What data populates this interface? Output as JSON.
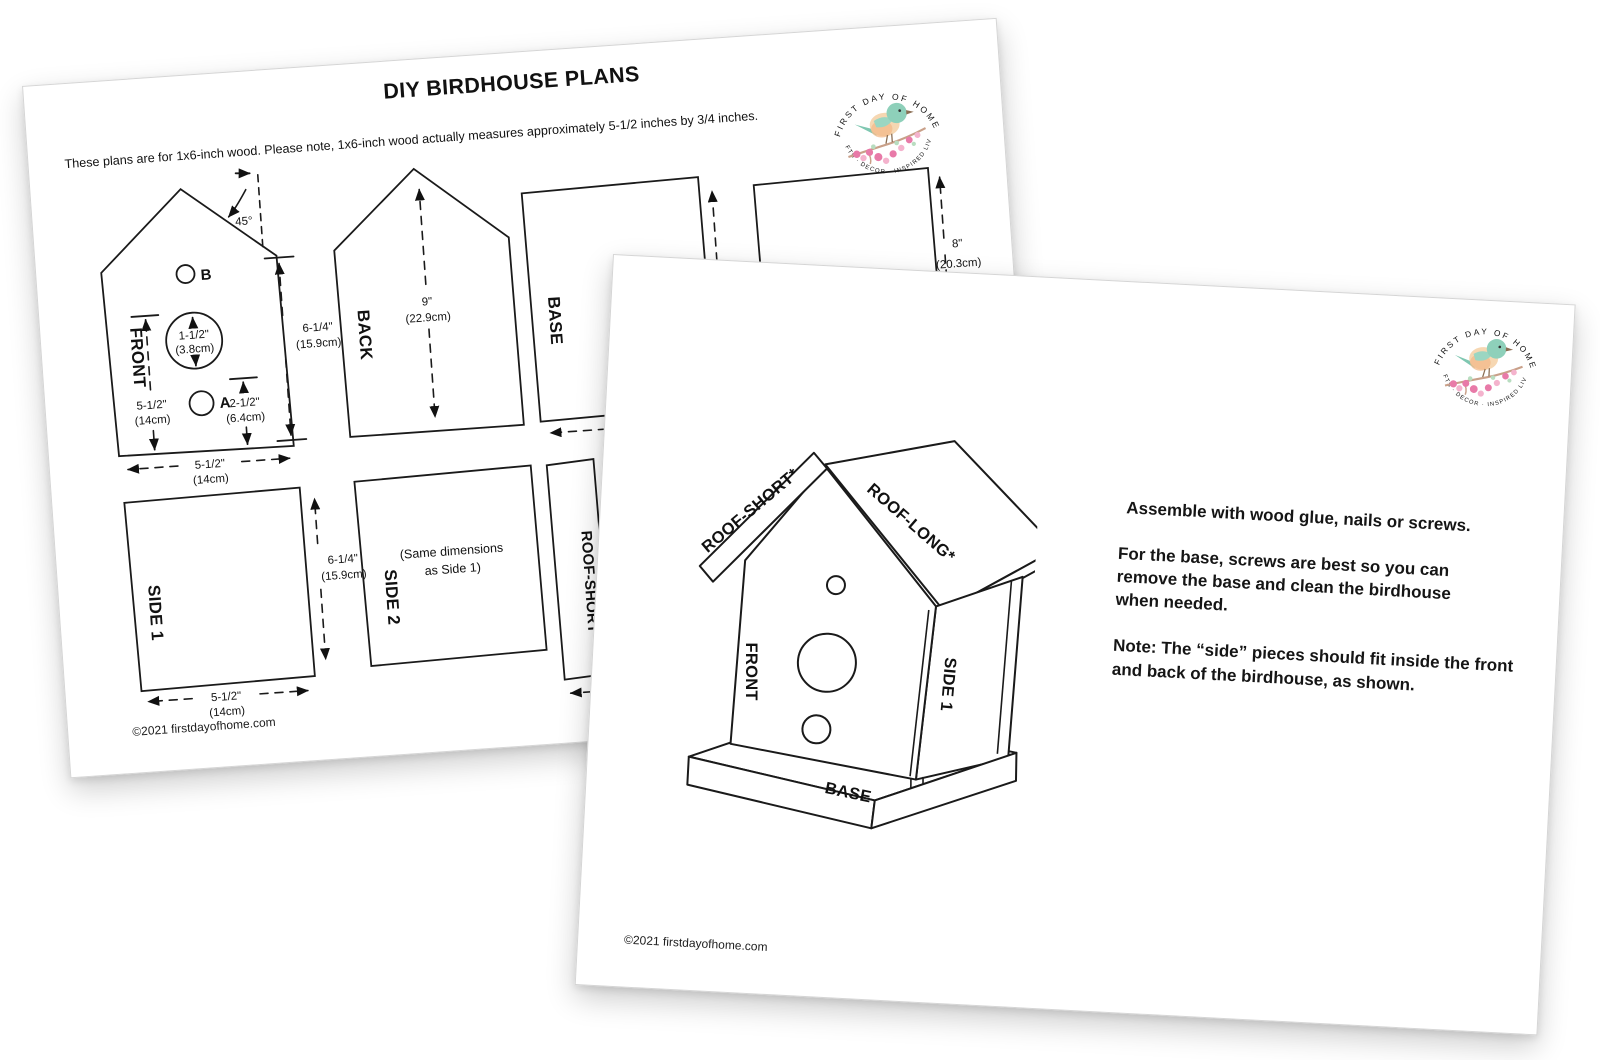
{
  "back_page": {
    "title": "DIY BIRDHOUSE PLANS",
    "subtitle": "These plans are for 1x6-inch wood. Please note, 1x6-inch wood actually measures approximately 5-1/2 inches by 3/4 inches.",
    "copyright": "©2021 firstdayofhome.com",
    "front_piece": {
      "label": "FRONT",
      "angle_label": "45°",
      "hole_b_label": "B",
      "hole_a_label": "A",
      "hole_dia_in": "1-1/2\"",
      "hole_dia_cm": "(3.8cm)",
      "left_height_in": "5-1/2\"",
      "left_height_cm": "(14cm)",
      "hole_a_offset_in": "2-1/2\"",
      "hole_a_offset_cm": "(6.4cm)",
      "right_height_in": "6-1/4\"",
      "right_height_cm": "(15.9cm)",
      "width_in": "5-1/2\"",
      "width_cm": "(14cm)"
    },
    "back_piece": {
      "label": "BACK",
      "height_in": "9\"",
      "height_cm": "(22.9cm)"
    },
    "base_piece": {
      "label": "BASE"
    },
    "roof_long_piece": {
      "height_in": "8\"",
      "height_cm": "(20.3cm)"
    },
    "side1_piece": {
      "label": "SIDE 1",
      "width_in": "5-1/2\"",
      "width_cm": "(14cm)",
      "height_in": "6-1/4\"",
      "height_cm": "(15.9cm)"
    },
    "side2_piece": {
      "label": "SIDE 2",
      "note1": "(Same dimensions",
      "note2": "as Side 1)"
    },
    "roof_short_piece": {
      "label": "ROOF-SHORT*"
    }
  },
  "front_page": {
    "labels": {
      "roof_short": "ROOF-SHORT*",
      "roof_long": "ROOF-LONG*",
      "front": "FRONT",
      "side1": "SIDE 1",
      "base": "BASE"
    },
    "instructions": [
      "Assemble with wood glue, nails or screws.",
      "For the base, screws are best so you can remove the base and clean the birdhouse when needed.",
      "Note: The “side” pieces should fit inside the front and back of the birdhouse, as shown."
    ],
    "copyright": "©2021 firstdayofhome.com"
  },
  "logo": {
    "top_text": "FIRST DAY OF HOME",
    "bottom_text": "CRAFTS · DECOR · INSPIRED LIVING",
    "colors": {
      "bird_head": "#8ed0ba",
      "bird_body": "#f6d7b2",
      "blossom": "#e87aa8",
      "ring_text": "#8f8f8f"
    }
  }
}
